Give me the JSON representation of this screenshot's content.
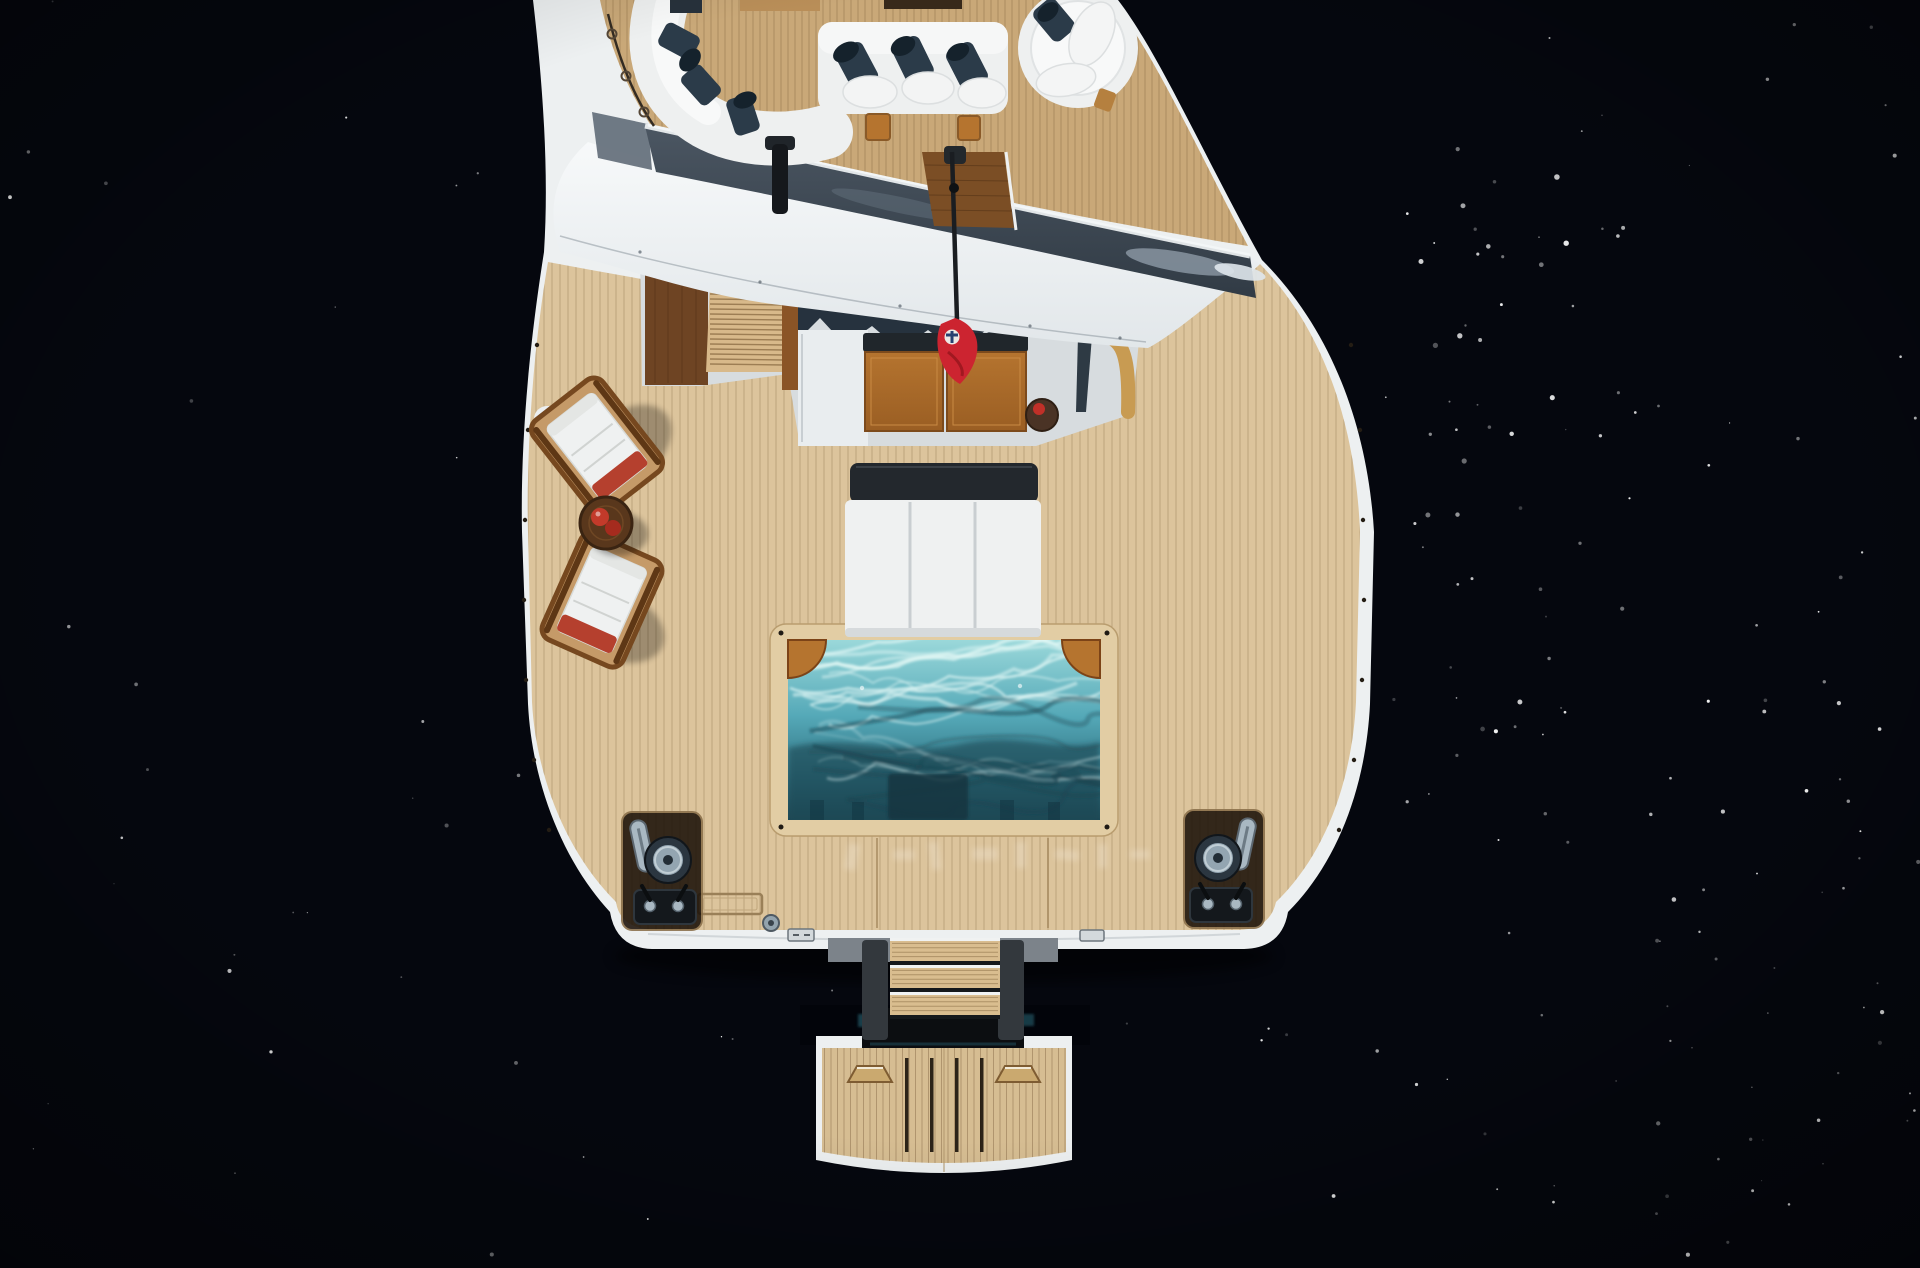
{
  "meta": {
    "title": "Aerial top-down photograph of a superyacht aft decks, plunge pool and swim platform over near-black sea",
    "type": "photograph",
    "view": "top-down aerial",
    "lighting": "bright daylight, dark deep-blue water with sun glints"
  },
  "palette": {
    "water": "#05070e",
    "water_glint": "#ffffff",
    "hull_white": "#edf0f1",
    "overhang_white_top": "#f7f9fa",
    "overhang_white_bottom": "#e2e7ea",
    "recess_grey": "#d7dcdf",
    "windshield_dark": "#313b45",
    "windshield_light": "#4b5662",
    "windshield_frame": "#f3f6f7",
    "teak_main": "#dcc49c",
    "teak_plank_line": "#8a6f4a",
    "teak_sundeck": "#c9a878",
    "sundeck_plank_line": "#8a6b42",
    "teak_platform": "#d6bd92",
    "tread_teak": "#d9bd8f",
    "wood_orange": "#b5742f",
    "wood_orange_dark": "#7c4a1c",
    "wood_dark_panel": "#6e4423",
    "companionway_wood": "#d8b98a",
    "navy_cushion": "#2b3b49",
    "navy_cushion_dark": "#15222c",
    "awning_navy": "#26323e",
    "black_pad": "#23282d",
    "white_cushion": "#eff1f1",
    "chair_wood": "#c59a68",
    "chair_wood_dark": "#76481f",
    "chair_red": "#b5402e",
    "table_wood_dark": "#59371c",
    "pool_shallow": "#9ad8da",
    "pool_mid": "#55a9b8",
    "pool_deep": "#1d4956",
    "pool_caustic": "#e4f8f6",
    "coping": "#e2cda4",
    "flag_red": "#cc2430",
    "flag_emblem_blue": "#274070",
    "chrome": "#a9b8c2",
    "console_black": "#14181c",
    "gold_cap": "#c89b52",
    "stair_rail_grey": "#33383d",
    "stair_step_grey": "#7c838a"
  },
  "scene": {
    "water": {
      "label": "deep dark sea surface with scattered sun glints, denser on the right"
    },
    "yacht": {
      "sundeck": {
        "label": "top sun deck",
        "curved_sofa": "white curved sectional sofa with navy cushions",
        "straight_sofa": "white straight sofa with navy pillows",
        "round_daybed": "round white daybed",
        "side_tables": "small teak side tables",
        "aft_teak_corner": "dark teak aft corner decking",
        "rail": "side rail with stanchion rings",
        "mast": "black aerial mast",
        "windshield": "tinted aft windscreen band"
      },
      "main_deck": {
        "label": "main aft deck in teak",
        "companionway": "teak stairway up to sun deck flanked by dark wood panels",
        "awning": "folded navy sunshade",
        "teak_tables": "pair of square teak tables with black seat band",
        "round_side_table": "dark round side table with red towel",
        "flag": "red ensign on black staff",
        "deck_chairs": "two folding teak deck chairs with white cushions and red throws",
        "chairs_table": "round teak table with red items",
        "sunpads": "triple white sunpad with black headrest pad",
        "bulwark_arch": "arched niche in port bulwark",
        "gold_trim": "gold-capped starboard bulwark corner"
      },
      "pool": {
        "label": "rectangular plunge pool with teak coping",
        "corner_seats": "two quarter-round teak corner seats",
        "bench": "submerged dark bench",
        "water": "turquoise water with light caustics, darker toward aft"
      },
      "aft": {
        "mooring_port": "port capstan winch, chrome cleat and control console",
        "mooring_starboard": "starboard capstan winch, chrome fairlead and control console",
        "hatches": "flush deck hatch and round deck fitting",
        "markings": "faint pale markings on aft deck (illegible)",
        "transom": "white transom edge"
      },
      "stern": {
        "stairs": "three teak steps between grey rails down to platform",
        "platform": "floating teak swim platform with four scupper slots and two folding cleat wedges"
      }
    }
  },
  "render": {
    "speckles": {
      "seed": 9,
      "zones": [
        {
          "x0": 1330,
          "x1": 1920,
          "y0": 0,
          "y1": 1268,
          "n": 85,
          "rmax": 1.6
        },
        {
          "x0": 1400,
          "x1": 1580,
          "y0": 140,
          "y1": 760,
          "n": 35,
          "rmax": 2.3
        },
        {
          "x0": 1620,
          "x1": 1920,
          "y0": 700,
          "y1": 1268,
          "n": 25,
          "rmax": 1.8
        },
        {
          "x0": 0,
          "x1": 480,
          "y0": 0,
          "y1": 460,
          "n": 10,
          "rmax": 1.4
        },
        {
          "x0": 0,
          "x1": 520,
          "y0": 620,
          "y1": 1268,
          "n": 20,
          "rmax": 1.6
        },
        {
          "x0": 540,
          "x1": 1320,
          "y0": 990,
          "y1": 1268,
          "n": 9,
          "rmax": 1.3
        },
        {
          "x0": 1380,
          "x1": 1560,
          "y0": 250,
          "y1": 650,
          "n": 5,
          "rmax": 3.0
        }
      ]
    },
    "planks": [
      {
        "clip": "clipMainDeck",
        "x0": 520,
        "x1": 1384,
        "y0": 238,
        "y1": 950,
        "sp": 8,
        "color": "teak_plank_line",
        "op": 0.38
      },
      {
        "clip": "clipSundeck",
        "x0": 592,
        "x1": 1258,
        "y0": 0,
        "y1": 252,
        "sp": 7,
        "color": "sundeck_plank_line",
        "op": 0.45
      },
      {
        "clip": "clipPlatform",
        "x0": 818,
        "x1": 1070,
        "y0": 1040,
        "y1": 1178,
        "sp": 6.5,
        "color": "teak_plank_line",
        "op": 0.5
      }
    ],
    "caustics": {
      "seed": 5,
      "light": 16,
      "dark": 8
    },
    "stairs_slats": {
      "x0": 710,
      "x1": 784,
      "y0": 289,
      "y1": 368,
      "sp": 5
    }
  }
}
